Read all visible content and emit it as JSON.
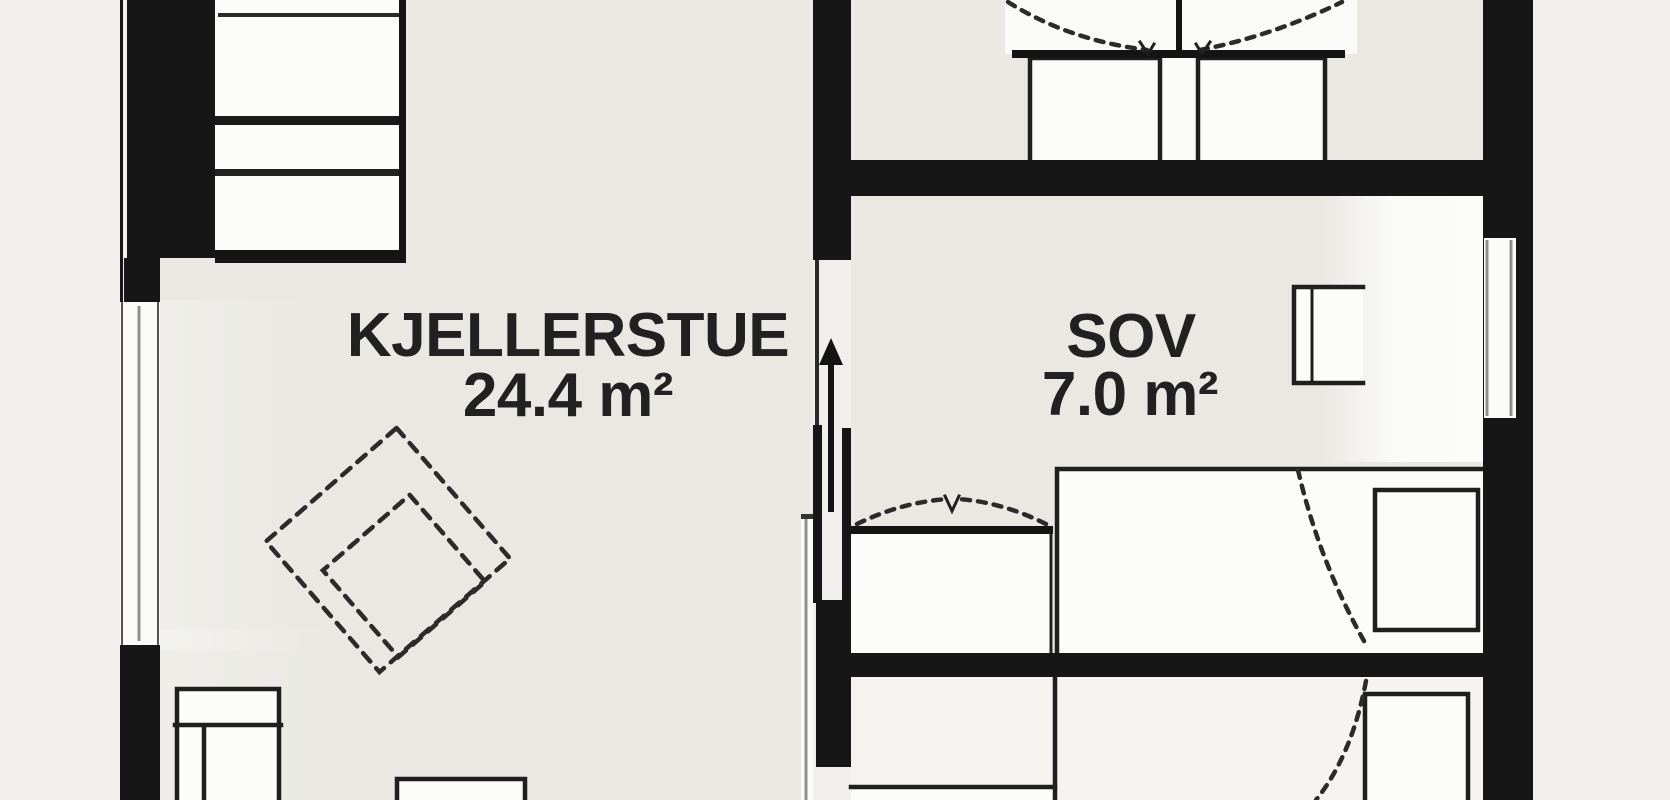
{
  "document_kind": "basement floor plan drawing",
  "rooms": [
    {
      "name": "KJELLERSTUE",
      "area": "24.4 m²"
    },
    {
      "name": "SOV",
      "area": "7.0 m²"
    }
  ],
  "symbols": [
    "stairs-icon",
    "up-arrow-icon",
    "window-icon",
    "wardrobe-double-door-swing-icon",
    "door-swing-arc-icon",
    "bed-icon",
    "pillow-icon",
    "armchair-dashed-icon",
    "sofa-icon",
    "side-table-icon",
    "wall-shelf-icon",
    "closet-icon"
  ],
  "colors": {
    "background": "#f0efeb",
    "room_fill": "#e9e8e3",
    "light_room_fill": "#f5f4f1",
    "furniture_fill": "#fcfcfa",
    "wall": "#161616",
    "line_color": "#1f1f1f",
    "dash_color": "#2b2b2b",
    "glass_color": "#8f8f8c",
    "text_color": "#212121"
  }
}
